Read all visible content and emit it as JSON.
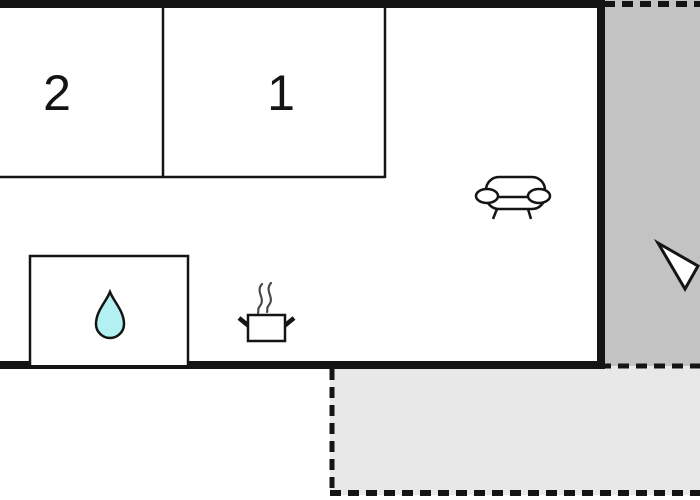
{
  "floor_plan": {
    "rooms": [
      {
        "id": "room-2",
        "label": "2"
      },
      {
        "id": "room-1",
        "label": "1"
      }
    ],
    "icons": [
      "water-drop-icon",
      "cooking-pot-icon",
      "steam-icon",
      "sofa-icon",
      "direction-arrow-icon"
    ],
    "colors": {
      "wall": "#141414",
      "terrace_dark": "#c3c3c3",
      "terrace_light": "#e8e8e8",
      "water_drop_fill": "#b3f0f2",
      "steam_stroke": "#4a4a4a",
      "background": "#ffffff"
    }
  }
}
